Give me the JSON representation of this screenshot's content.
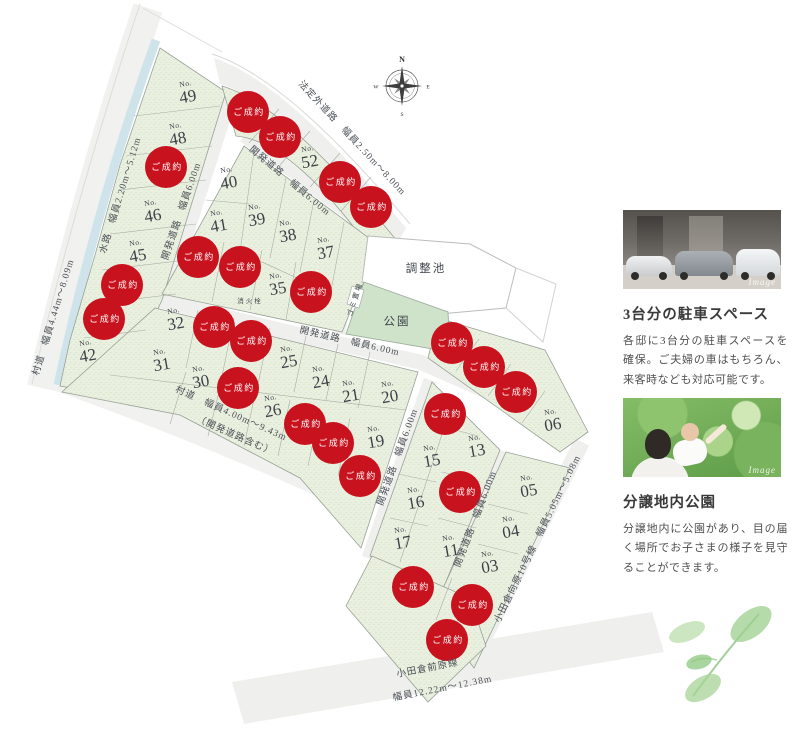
{
  "map": {
    "compass": {
      "north": "N",
      "east": "E",
      "south": "S",
      "west": "W"
    },
    "no_prefix": "No.",
    "sold_label": "ご成約",
    "lots": [
      {
        "no": "49",
        "x": 187,
        "y": 92
      },
      {
        "no": "48",
        "x": 177,
        "y": 134
      },
      {
        "no": "46",
        "x": 152,
        "y": 211
      },
      {
        "no": "45",
        "x": 137,
        "y": 251
      },
      {
        "no": "42",
        "x": 87,
        "y": 351
      },
      {
        "no": "52",
        "x": 309,
        "y": 157
      },
      {
        "no": "40",
        "x": 228,
        "y": 178
      },
      {
        "no": "41",
        "x": 218,
        "y": 221
      },
      {
        "no": "39",
        "x": 256,
        "y": 215
      },
      {
        "no": "38",
        "x": 287,
        "y": 231
      },
      {
        "no": "37",
        "x": 325,
        "y": 248
      },
      {
        "no": "35",
        "x": 277,
        "y": 284
      },
      {
        "no": "32",
        "x": 175,
        "y": 319
      },
      {
        "no": "31",
        "x": 161,
        "y": 360
      },
      {
        "no": "30",
        "x": 200,
        "y": 377
      },
      {
        "no": "26",
        "x": 272,
        "y": 406
      },
      {
        "no": "25",
        "x": 288,
        "y": 357
      },
      {
        "no": "24",
        "x": 320,
        "y": 377
      },
      {
        "no": "21",
        "x": 350,
        "y": 391
      },
      {
        "no": "20",
        "x": 389,
        "y": 392
      },
      {
        "no": "19",
        "x": 375,
        "y": 437
      },
      {
        "no": "15",
        "x": 431,
        "y": 456
      },
      {
        "no": "16",
        "x": 415,
        "y": 498
      },
      {
        "no": "17",
        "x": 402,
        "y": 538
      },
      {
        "no": "13",
        "x": 476,
        "y": 446
      },
      {
        "no": "11",
        "x": 450,
        "y": 546
      },
      {
        "no": "06",
        "x": 552,
        "y": 420
      },
      {
        "no": "05",
        "x": 528,
        "y": 486
      },
      {
        "no": "04",
        "x": 510,
        "y": 527
      },
      {
        "no": "03",
        "x": 489,
        "y": 562
      }
    ],
    "sold_markers": [
      {
        "x": 166,
        "y": 167
      },
      {
        "x": 122,
        "y": 285
      },
      {
        "x": 104,
        "y": 319
      },
      {
        "x": 248,
        "y": 112
      },
      {
        "x": 280,
        "y": 137
      },
      {
        "x": 340,
        "y": 182
      },
      {
        "x": 371,
        "y": 207
      },
      {
        "x": 198,
        "y": 257
      },
      {
        "x": 240,
        "y": 267
      },
      {
        "x": 311,
        "y": 292
      },
      {
        "x": 214,
        "y": 327
      },
      {
        "x": 251,
        "y": 341
      },
      {
        "x": 238,
        "y": 388
      },
      {
        "x": 305,
        "y": 424
      },
      {
        "x": 333,
        "y": 443
      },
      {
        "x": 360,
        "y": 476
      },
      {
        "x": 445,
        "y": 414
      },
      {
        "x": 460,
        "y": 492
      },
      {
        "x": 452,
        "y": 343
      },
      {
        "x": 484,
        "y": 367
      },
      {
        "x": 516,
        "y": 392
      },
      {
        "x": 413,
        "y": 587
      },
      {
        "x": 472,
        "y": 605
      },
      {
        "x": 447,
        "y": 640
      }
    ],
    "road_labels": [
      {
        "text": "村道　幅員4.44m〜8.09m",
        "x": 56,
        "y": 318,
        "r": -73
      },
      {
        "text": "水路　幅員2.20m〜5.12m",
        "x": 123,
        "y": 196,
        "r": -73
      },
      {
        "text": "法定外道路　幅員2.50m〜8.00m",
        "x": 350,
        "y": 140,
        "r": 47
      },
      {
        "text": "開発道路　幅員6.00m",
        "x": 184,
        "y": 212,
        "r": -71
      },
      {
        "text": "開発道路　幅員6.00m",
        "x": 288,
        "y": 183,
        "r": 40
      },
      {
        "text": "開発道路　幅員6.00m",
        "x": 349,
        "y": 344,
        "r": 13
      },
      {
        "text": "村道　幅員4.00m〜9.43m",
        "x": 230,
        "y": 416,
        "r": 24
      },
      {
        "text": "（開発道路含む）",
        "x": 234,
        "y": 438,
        "r": 24
      },
      {
        "text": "開発道路　幅員6.00m",
        "x": 400,
        "y": 458,
        "r": -70
      },
      {
        "text": "開発道路　幅員6.00m",
        "x": 478,
        "y": 520,
        "r": -69
      },
      {
        "text": "小田倉向原10号線　幅員5.05m〜5.08m",
        "x": 540,
        "y": 540,
        "r": -64
      },
      {
        "text": "小田倉前原線",
        "x": 428,
        "y": 671,
        "r": -11
      },
      {
        "text": "幅員12.22m〜12.38m",
        "x": 443,
        "y": 691,
        "r": -11
      }
    ],
    "facility_labels": [
      {
        "text": "調整池",
        "x": 426,
        "y": 272,
        "r": 0,
        "size": 11.5
      },
      {
        "text": "公園",
        "x": 397,
        "y": 325,
        "r": 0,
        "size": 11.5
      },
      {
        "text": "ゴミ置場",
        "x": 357,
        "y": 300,
        "r": -72,
        "size": 7
      },
      {
        "text": "消火栓",
        "x": 250,
        "y": 303,
        "r": 0,
        "size": 6.5
      }
    ]
  },
  "panel": {
    "sections": [
      {
        "image_label": "Image",
        "title": "3台分の駐車スペース",
        "body": "各邸に3台分の駐車スペースを確保。ご夫婦の車はもちろん、来客時なども対応可能です。"
      },
      {
        "image_label": "Image",
        "title": "分譲地内公園",
        "body": "分譲地内に公園があり、目の届く場所でお子さまの様子を見守ることができます。"
      }
    ]
  },
  "colors": {
    "sold_red": "#c8121e",
    "lot_green": "#eaf0e0",
    "park_green": "#cfe3cb",
    "road_gray": "#efefed",
    "water_blue": "#cfe4ea",
    "label_dark": "#3f444b"
  }
}
